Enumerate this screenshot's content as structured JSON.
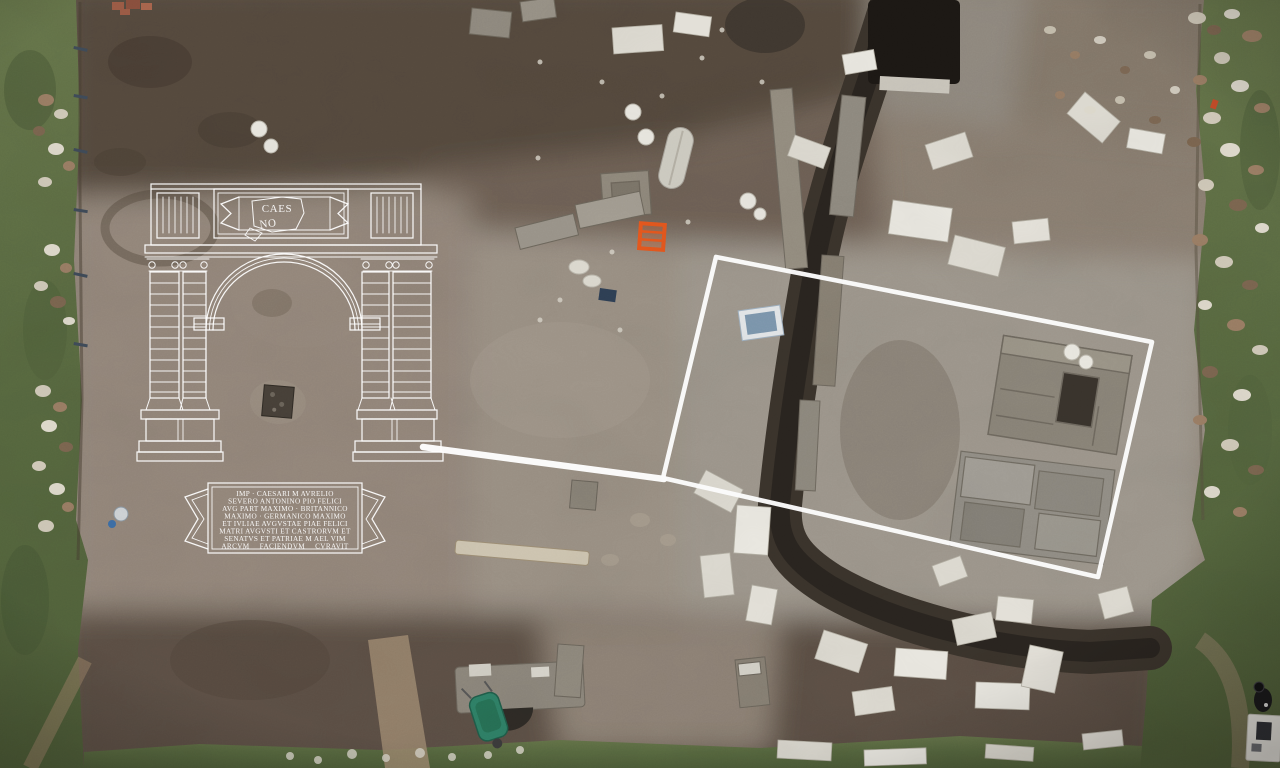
{
  "overlay": {
    "fragment": {
      "line1": "CAES",
      "line2": "NO"
    },
    "plaque": {
      "lines": [
        "IMP · CAESARI M AVRELIO",
        "SEVERO ANTONINO PIO FELICI",
        "AVG PART MAXIMO · BRITANNICO",
        "MAXIMO · GERMANICO MAXIMO",
        "ET IVLIAE AVGVSTAE PIAE FELICI",
        "MATRI AVGVSTI ET CASTRORVM ET",
        "SENATVS ET PATRIAE M AEL VIM",
        "ARCVM FACIENDVM CVRAVIT"
      ]
    }
  },
  "colors": {
    "overlay_line": "#ffffff",
    "highlight_box": "#fbfbfb",
    "leader_line": "#fdfdfd",
    "grass": "#5e6e44",
    "earth_dark": "#564a3e",
    "earth_mid": "#8d8176",
    "earth_light": "#9c948a",
    "marble": "#dedbd2",
    "trench": "#322d27",
    "chair_orange": "#e4571d",
    "wheelbarrow_teal": "#2e8066",
    "tray_blue": "#7c96ad",
    "person_dark": "#17171a"
  }
}
